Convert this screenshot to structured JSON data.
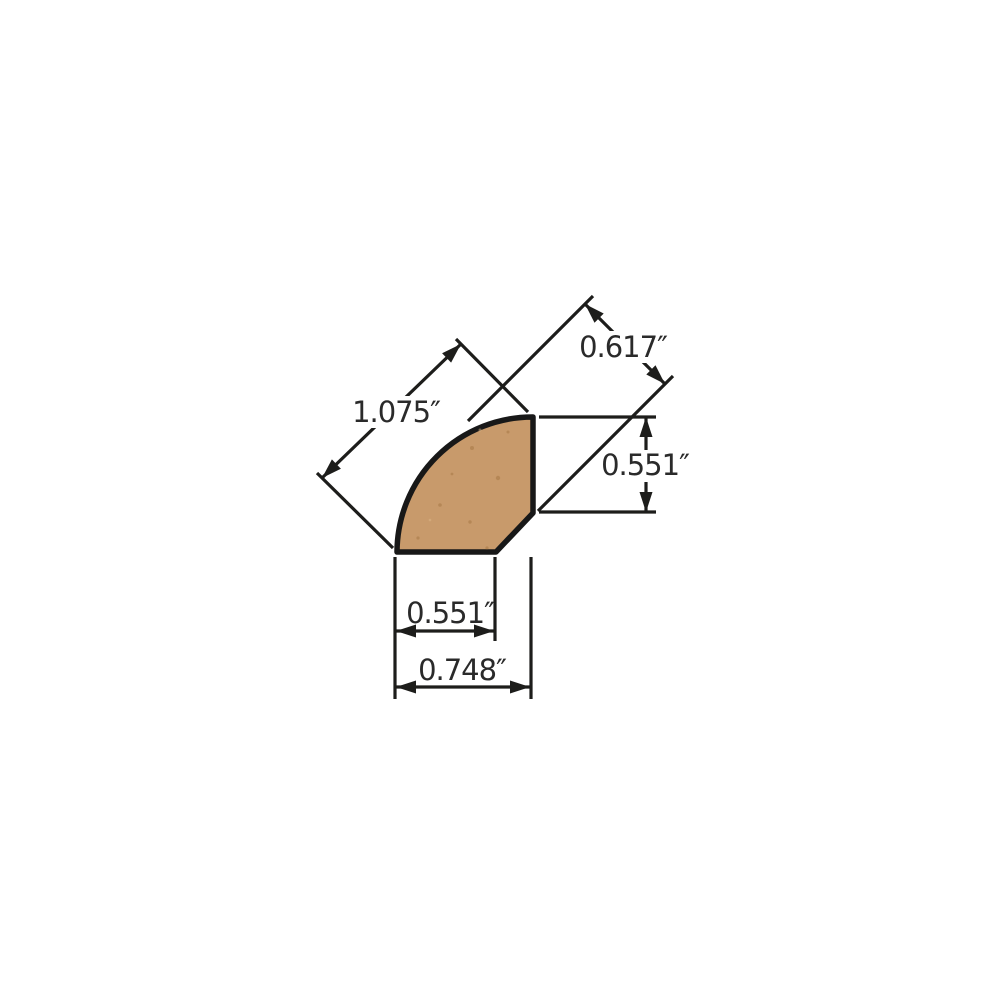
{
  "page": {
    "background": "#ffffff"
  },
  "diagram": {
    "kind": "molding profile cross-section dimension drawing",
    "profile": "quarter round",
    "units": "inches",
    "colors": {
      "wood_fill": "#C89A6B",
      "wood_speckle": "#A0713D",
      "outline": "#181818",
      "dimension_line": "#1D1D1B",
      "text": "#2A2A2A",
      "background": "#FFFFFF"
    },
    "dimensions": [
      {
        "id": "face-diagonal",
        "label": "1.075″",
        "value": 1.075,
        "placement": "upper-left diagonal, across curved face"
      },
      {
        "id": "top-projection",
        "label": "0.617″",
        "value": 0.617,
        "placement": "upper-right diagonal projection"
      },
      {
        "id": "right-face-height",
        "label": "0.551″",
        "value": 0.551,
        "placement": "right side vertical"
      },
      {
        "id": "bottom-inner-width",
        "label": "0.551″",
        "value": 0.551,
        "placement": "bottom horizontal, flat face"
      },
      {
        "id": "overall-width",
        "label": "0.748″",
        "value": 0.748,
        "placement": "bottom horizontal, overall"
      }
    ]
  }
}
